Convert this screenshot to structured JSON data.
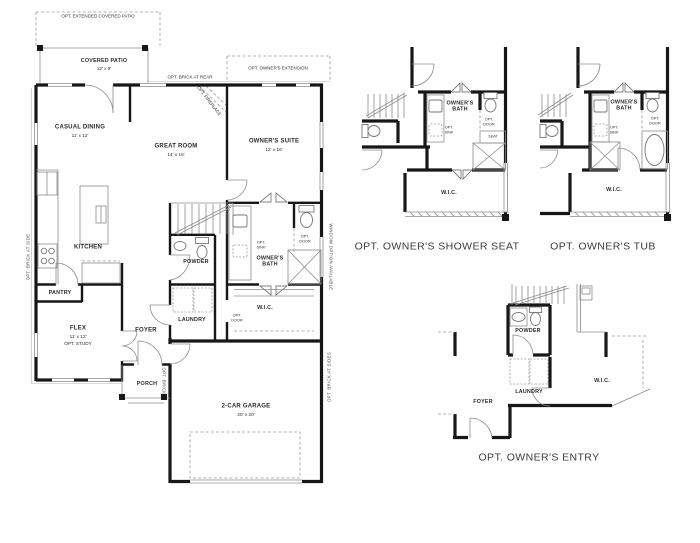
{
  "colors": {
    "wall": "#171717",
    "line": "#8c8c8c",
    "label": "#2c2c2c",
    "caption": "#3c3c3c",
    "background": "#ffffff"
  },
  "main_plan": {
    "rooms": {
      "covered_patio": {
        "name": "COVERED PATIO",
        "dim": "12' x 9'"
      },
      "casual_dining": {
        "name": "CASUAL DINING",
        "dim": "11' x 12'"
      },
      "great_room": {
        "name": "GREAT ROOM",
        "dim": "14' x 16'"
      },
      "owners_suite": {
        "name": "OWNER'S SUITE",
        "dim": "12' x 16'"
      },
      "kitchen": {
        "name": "KITCHEN"
      },
      "pantry": {
        "name": "PANTRY"
      },
      "flex": {
        "name": "FLEX",
        "dim": "11' x 12'",
        "opt": "OPT. STUDY"
      },
      "foyer": {
        "name": "FOYER"
      },
      "powder": {
        "name": "POWDER"
      },
      "laundry": {
        "name": "LAUNDRY"
      },
      "porch": {
        "name": "PORCH"
      },
      "garage": {
        "name": "2-CAR GARAGE",
        "dim": "20' x 20'"
      },
      "owners_bath": {
        "name": "OWNER'S\nBATH"
      },
      "wic": {
        "name": "W.I.C."
      }
    },
    "notes": {
      "opt_extended_patio": "OPT. EXTENDED COVERED PATIO",
      "opt_brick_rear": "OPT. BRICK AT REAR",
      "opt_owners_extension": "OPT. OWNER'S EXTENSION",
      "opt_fireplace": "OPT. FIREPLACE",
      "opt_sink": "OPT.\nSINK",
      "opt_door": "OPT.\nDOOR",
      "window_option": "WINDOW OPTION AVAILABLE",
      "opt_brick_side": "OPT. BRICK AT SIDE",
      "opt_brick_sides": "OPT. BRICK AT SIDES",
      "opt_brick": "OPT. BRICK"
    }
  },
  "details": {
    "shower_seat": {
      "caption": "OPT. OWNER'S SHOWER SEAT",
      "owners_bath": "OWNER'S\nBATH",
      "opt_sink": "OPT.\nSINK",
      "opt_door": "OPT.\nDOOR",
      "seat": "SEAT",
      "wic": "W.I.C."
    },
    "tub": {
      "caption": "OPT. OWNER'S TUB",
      "owners_bath": "OWNER'S\nBATH",
      "opt_sink": "OPT.\nSINK",
      "opt_door": "OPT.\nDOOR",
      "wic": "W.I.C."
    },
    "entry": {
      "caption": "OPT. OWNER'S ENTRY",
      "powder": "POWDER",
      "laundry": "LAUNDRY",
      "foyer": "FOYER",
      "wic": "W.I.C."
    }
  }
}
